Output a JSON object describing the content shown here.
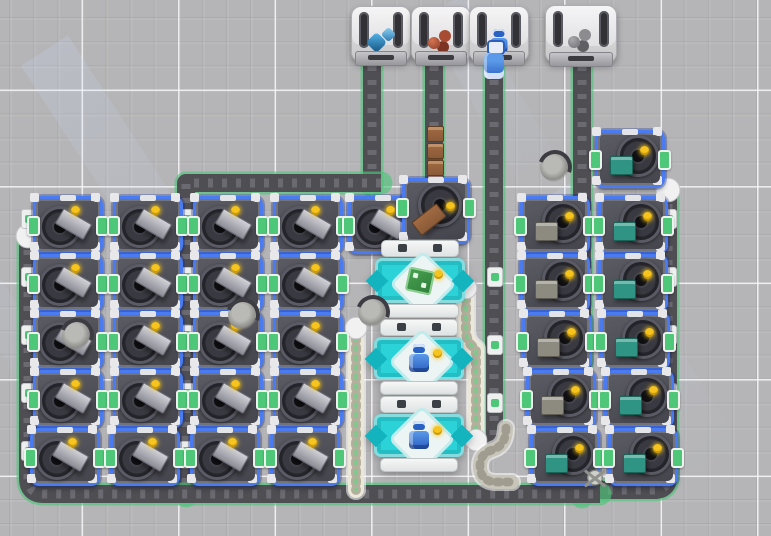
{
  "scene": {
    "width": 771,
    "height": 536,
    "description": "top-down factory build view with extractors, assemblers, conveyor belts and delivery hoppers"
  },
  "palette": {
    "extractor_border_blue": "#4a7bf0",
    "assembler_teal": "#2bd2d8",
    "indicator_yellow": "#f6c41c",
    "port_green": "#4ec878",
    "belt_dark": "#4e4e53",
    "belt_chevron": "#6a6a70",
    "belt_edge_green": "#4fc479",
    "itembelt_base": "#ebe8da",
    "itembelt_slot": "#b3af9c",
    "itembelt_dot": "#7fc98f",
    "graybelt_base": "#c8c5ba",
    "graybelt_slot": "#a09d90",
    "resource_teal": "#2f9483",
    "resource_stone": "#8d8a80",
    "resource_wood": "#8a5a38"
  },
  "hoppers": [
    {
      "x": 351,
      "y": 6,
      "w": 58,
      "h": 54,
      "item": "crystal"
    },
    {
      "x": 411,
      "y": 6,
      "w": 58,
      "h": 54,
      "item": "copper"
    },
    {
      "x": 469,
      "y": 6,
      "w": 58,
      "h": 54,
      "item": "robot"
    },
    {
      "x": 545,
      "y": 5,
      "w": 70,
      "h": 56,
      "item": "stone"
    }
  ],
  "belts": [
    {
      "id": "hopper1-down",
      "kind": "dark",
      "width": 18,
      "path": "M372,52 L372,186",
      "caps": []
    },
    {
      "id": "west-feed",
      "kind": "dark",
      "width": 18,
      "path": "M381,183 L186,183 L186,496",
      "caps": []
    },
    {
      "id": "hopper2-down",
      "kind": "dark",
      "width": 18,
      "path": "M434,52 L434,190",
      "caps": []
    },
    {
      "id": "hopper3-down",
      "kind": "dark",
      "width": 18,
      "path": "M494,52 L494,444",
      "caps": []
    },
    {
      "id": "hopper4-down",
      "kind": "dark",
      "width": 18,
      "path": "M582,52 L582,497",
      "caps": []
    },
    {
      "id": "east-edge",
      "kind": "dark",
      "width": 18,
      "path": "M668,190 L668,477 Q668,490 654,490 L596,490",
      "caps": [
        [
          668,
          190
        ]
      ]
    },
    {
      "id": "west-edge-bottom",
      "kind": "dark",
      "width": 18,
      "path": "M28,236 L28,478 Q28,494 44,494 L600,494",
      "caps": [
        [
          28,
          236
        ]
      ]
    },
    {
      "id": "mid-item-belt",
      "kind": "item",
      "width": 16,
      "path": "M356,328 L356,490",
      "caps": [
        [
          356,
          328
        ]
      ]
    },
    {
      "id": "assembler-feed-belt",
      "kind": "item",
      "width": 16,
      "path": "M466,288 L466,330 Q466,343 476,349 L476,440",
      "caps": [
        [
          466,
          288
        ],
        [
          476,
          440
        ]
      ]
    },
    {
      "id": "s-curve-belt",
      "kind": "gray",
      "width": 14,
      "path": "M506,428 Q506,446 492,450 Q480,454 480,466 Q480,481 495,482 L512,482",
      "caps": []
    }
  ],
  "junctions": [
    [
      28,
      218
    ],
    [
      28,
      276
    ],
    [
      28,
      334
    ],
    [
      28,
      392
    ],
    [
      28,
      450
    ],
    [
      186,
      218
    ],
    [
      186,
      276
    ],
    [
      186,
      334
    ],
    [
      186,
      392
    ],
    [
      186,
      450
    ],
    [
      582,
      218
    ],
    [
      582,
      276
    ],
    [
      582,
      334
    ],
    [
      582,
      392
    ],
    [
      582,
      450
    ],
    [
      668,
      218
    ],
    [
      668,
      276
    ],
    [
      668,
      334
    ],
    [
      668,
      392
    ],
    [
      668,
      450
    ],
    [
      494,
      276
    ],
    [
      494,
      344
    ],
    [
      494,
      402
    ]
  ],
  "extractors": [
    {
      "x": 33,
      "y": 196,
      "v": "left",
      "res": "iron"
    },
    {
      "x": 113,
      "y": 196,
      "v": "left",
      "res": "iron"
    },
    {
      "x": 193,
      "y": 196,
      "v": "left",
      "res": "iron"
    },
    {
      "x": 273,
      "y": 196,
      "v": "left",
      "res": "iron"
    },
    {
      "x": 348,
      "y": 196,
      "v": "left",
      "res": "iron"
    },
    {
      "x": 33,
      "y": 254,
      "v": "left",
      "res": "iron"
    },
    {
      "x": 113,
      "y": 254,
      "v": "left",
      "res": "iron"
    },
    {
      "x": 193,
      "y": 254,
      "v": "left",
      "res": "iron"
    },
    {
      "x": 273,
      "y": 254,
      "v": "left",
      "res": "iron"
    },
    {
      "x": 33,
      "y": 312,
      "v": "left",
      "res": "iron"
    },
    {
      "x": 113,
      "y": 312,
      "v": "left",
      "res": "iron"
    },
    {
      "x": 193,
      "y": 312,
      "v": "left",
      "res": "iron"
    },
    {
      "x": 273,
      "y": 312,
      "v": "left",
      "res": "iron"
    },
    {
      "x": 33,
      "y": 370,
      "v": "left",
      "res": "iron"
    },
    {
      "x": 113,
      "y": 370,
      "v": "left",
      "res": "iron"
    },
    {
      "x": 193,
      "y": 370,
      "v": "left",
      "res": "iron"
    },
    {
      "x": 273,
      "y": 370,
      "v": "left",
      "res": "iron"
    },
    {
      "x": 30,
      "y": 428,
      "v": "left",
      "res": "iron"
    },
    {
      "x": 110,
      "y": 428,
      "v": "left",
      "res": "iron"
    },
    {
      "x": 190,
      "y": 428,
      "v": "left",
      "res": "iron"
    },
    {
      "x": 270,
      "y": 428,
      "v": "left",
      "res": "iron"
    },
    {
      "x": 402,
      "y": 178,
      "v": "top",
      "res": "wood"
    },
    {
      "x": 595,
      "y": 130,
      "v": "tr",
      "res": "teal"
    },
    {
      "x": 520,
      "y": 196,
      "v": "tr",
      "res": "stone"
    },
    {
      "x": 598,
      "y": 196,
      "v": "tr",
      "res": "teal"
    },
    {
      "x": 520,
      "y": 254,
      "v": "tr",
      "res": "stone"
    },
    {
      "x": 598,
      "y": 254,
      "v": "tr",
      "res": "teal"
    },
    {
      "x": 522,
      "y": 312,
      "v": "tr",
      "res": "stone"
    },
    {
      "x": 600,
      "y": 312,
      "v": "tr",
      "res": "teal"
    },
    {
      "x": 526,
      "y": 370,
      "v": "tr",
      "res": "stone"
    },
    {
      "x": 604,
      "y": 370,
      "v": "tr",
      "res": "teal"
    },
    {
      "x": 530,
      "y": 428,
      "v": "tr",
      "res": "teal"
    },
    {
      "x": 608,
      "y": 428,
      "v": "tr",
      "res": "teal"
    }
  ],
  "assemblers": [
    {
      "x": 375,
      "y": 240,
      "w": 90,
      "h": 78,
      "product": "circuit"
    },
    {
      "x": 374,
      "y": 319,
      "w": 90,
      "h": 76,
      "product": "robot"
    },
    {
      "x": 374,
      "y": 396,
      "w": 90,
      "h": 76,
      "product": "robot"
    }
  ],
  "robots": [
    {
      "type": "wreck",
      "x": 540,
      "y": 152
    },
    {
      "type": "wreck",
      "x": 358,
      "y": 297
    },
    {
      "type": "wreck",
      "x": 228,
      "y": 300
    },
    {
      "type": "wreck",
      "x": 62,
      "y": 320
    },
    {
      "type": "spider",
      "x": 578,
      "y": 462
    },
    {
      "type": "carrier",
      "x": 482,
      "y": 40
    }
  ],
  "belt_items": [
    {
      "x": 427,
      "y": 126,
      "r": 0
    },
    {
      "x": 427,
      "y": 143,
      "r": 0
    },
    {
      "x": 427,
      "y": 160,
      "r": 0
    },
    {
      "x": 427,
      "y": 175,
      "r": 0
    },
    {
      "x": 413,
      "y": 219,
      "r": -38
    }
  ],
  "beams": [
    {
      "x": 120,
      "y": 20,
      "w": 56,
      "h": 380,
      "r": -33,
      "o": 0.2
    },
    {
      "x": 480,
      "y": -10,
      "w": 46,
      "h": 240,
      "r": -30,
      "o": 0.16
    },
    {
      "x": 610,
      "y": 170,
      "w": 56,
      "h": 330,
      "r": -32,
      "o": 0.17
    },
    {
      "x": -10,
      "y": 210,
      "w": 40,
      "h": 240,
      "r": -33,
      "o": 0.15
    }
  ]
}
